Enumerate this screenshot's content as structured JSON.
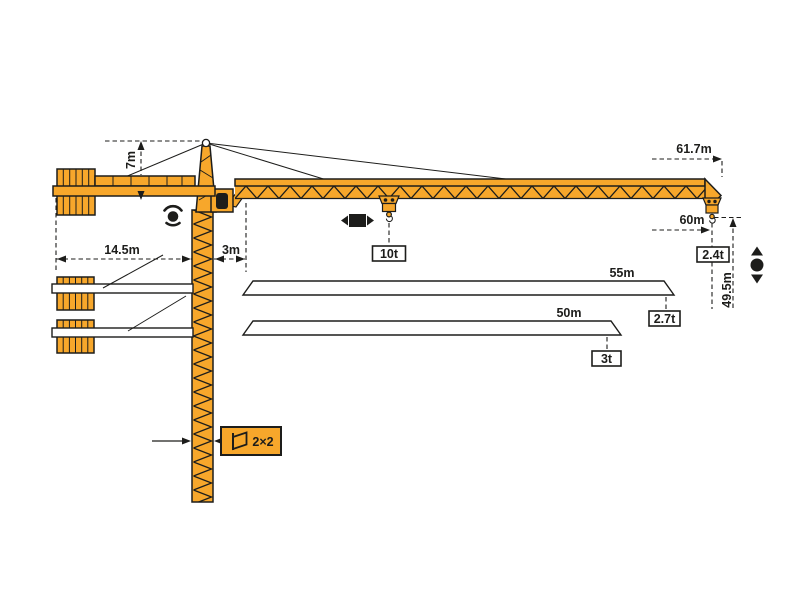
{
  "diagram_title": "tower-crane-working-range-diagram",
  "colors": {
    "crane_orange": "#F7A72B",
    "outline": "#1D1D1B",
    "background": "#FFFFFF",
    "label_box_background": "#FFFFFF",
    "icon_black": "#000000"
  },
  "labels": {
    "tower_head_height": "7m",
    "counter_jib_length": "14.5m",
    "jib_root_offset": "3m",
    "max_working_radius": "61.7m",
    "max_hook_radius": "60m",
    "hook_height": "49.5m",
    "max_capacity": "10t",
    "tip_load_max_jib": "2.4t",
    "jib_option_1_length": "55m",
    "jib_option_1_tip_load": "2.7t",
    "jib_option_2_length": "50m",
    "jib_option_2_tip_load": "3t",
    "mast_cross_section": "2×2"
  },
  "crane_specs": {
    "max_capacity": "10t",
    "configurations": [
      {
        "jib_length": "61.7m",
        "tip_load": "2.4t"
      },
      {
        "jib_length": "55m",
        "tip_load": "2.7t"
      },
      {
        "jib_length": "50m",
        "tip_load": "3t"
      }
    ]
  },
  "icons": {
    "slewing": "slewing-rotation-icon",
    "trolley_travel": "trolley-travel-icon",
    "hook_travel": "hook-travel-icon",
    "mast_section": "mast-section-icon"
  }
}
